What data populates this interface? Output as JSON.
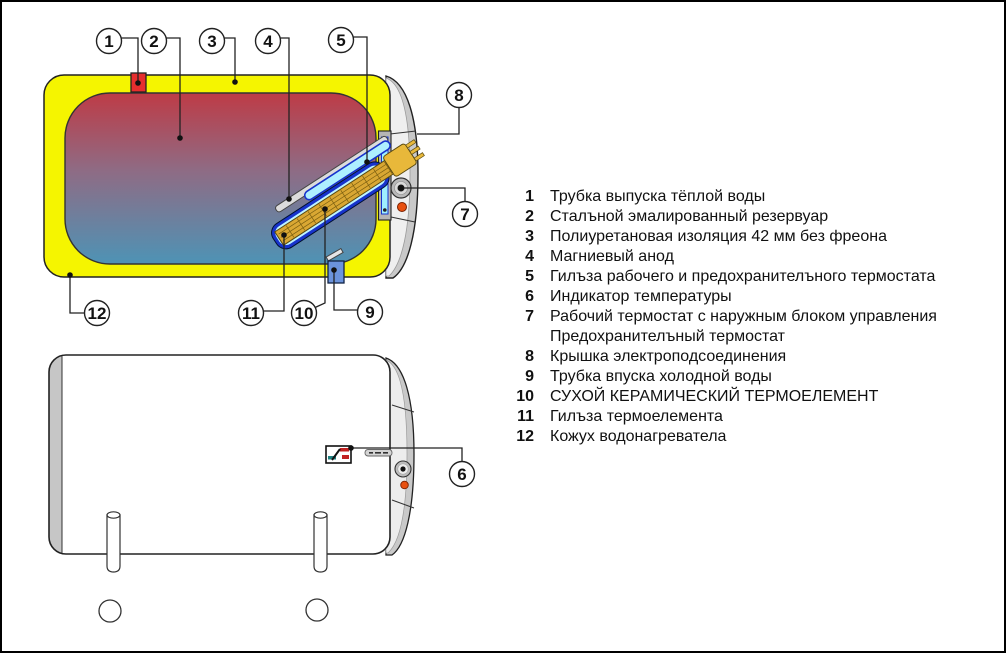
{
  "callouts": {
    "c1": "1",
    "c2": "2",
    "c3": "3",
    "c4": "4",
    "c5": "5",
    "c6": "6",
    "c7": "7",
    "c8": "8",
    "c9": "9",
    "c10": "10",
    "c11": "11",
    "c12": "12"
  },
  "legend": {
    "items": [
      {
        "num": "1",
        "text": "Трубка выпуска тёплой воды"
      },
      {
        "num": "2",
        "text": "Сталъной эмалированный резервуар"
      },
      {
        "num": "3",
        "text": "Полиуретановая изоляция 42 мм без фреона"
      },
      {
        "num": "4",
        "text": "Магниевый анод"
      },
      {
        "num": "5",
        "text": "Гилъза рабочего и предохранителъного термостата"
      },
      {
        "num": "6",
        "text": "Индикатор температуры"
      },
      {
        "num": "7",
        "text": "Рабочий термостат с наружным блоком управления"
      },
      {
        "num": "",
        "text": "Предохранителъный термостат"
      },
      {
        "num": "8",
        "text": "Крышка электроподсоединения"
      },
      {
        "num": "9",
        "text": "Трубка впуска холодной воды"
      },
      {
        "num": "10",
        "text": "СУХОЙ КЕРАМИЧЕСКИЙ ТЕРМОЕЛЕМЕНТ"
      },
      {
        "num": "11",
        "text": "Гилъза термоелемента"
      },
      {
        "num": "12",
        "text": "Кожух водонагревателa"
      }
    ]
  },
  "colors": {
    "insulation_yellow": "#F5F500",
    "tank_hot_red": "#BE3B46",
    "tank_cold_blue": "#4E93B5",
    "element_sleeve_blue": "#1733CC",
    "ceramic_element_gold": "#D9A733",
    "hot_pipe_red": "#E62E2E",
    "cold_pipe_blue": "#6B93DC",
    "indicator_orange": "#E85010",
    "cover_gray": "#C9C9C9"
  }
}
